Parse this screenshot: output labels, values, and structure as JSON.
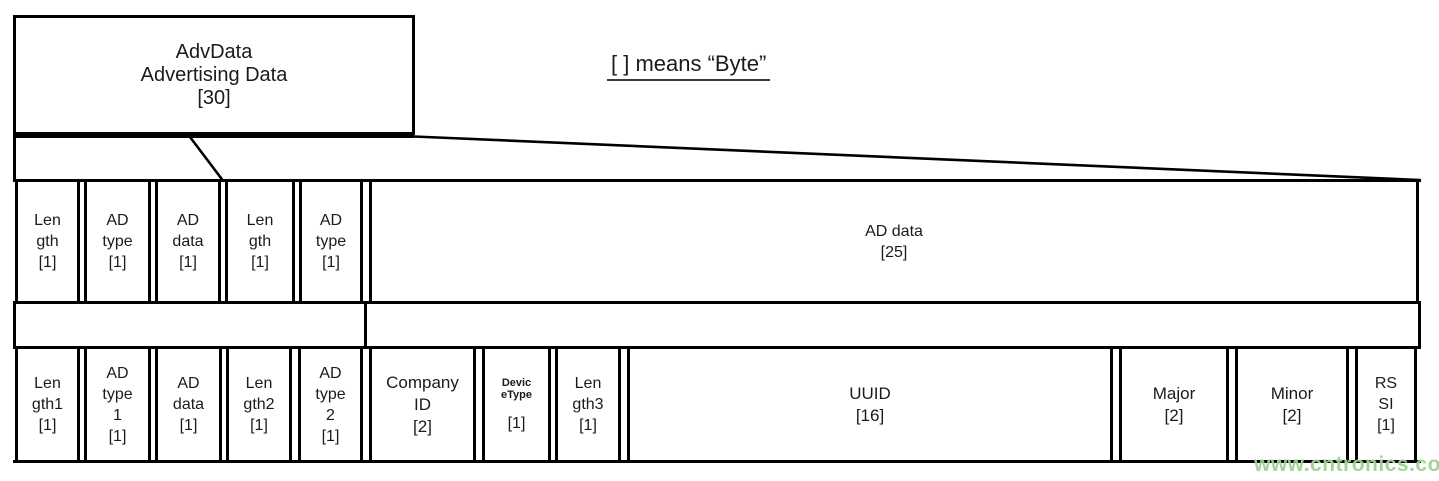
{
  "top_box": {
    "text": "AdvData\nAdvertising Data\n[30]"
  },
  "byte_note": {
    "text": "[ ] means “Byte”"
  },
  "middle_row": {
    "cells": [
      {
        "label": "Length",
        "text": "Len\ngth\n[1]"
      },
      {
        "label": "AD type",
        "text": "AD\ntype\n[1]"
      },
      {
        "label": "AD data",
        "text": "AD\ndata\n[1]"
      },
      {
        "label": "Length",
        "text": "Len\ngth\n[1]"
      },
      {
        "label": "AD type",
        "text": "AD\ntype\n[1]"
      },
      {
        "label": "AD data",
        "text": "AD data\n[25]"
      }
    ]
  },
  "bottom_row": {
    "cells": [
      {
        "label": "Length1",
        "text": "Len\ngth1\n[1]"
      },
      {
        "label": "AD type 1",
        "text": "AD\ntype\n1\n[1]"
      },
      {
        "label": "AD data",
        "text": "AD\ndata\n[1]"
      },
      {
        "label": "Length2",
        "text": "Len\ngth2\n[1]"
      },
      {
        "label": "AD type 2",
        "text": "AD\ntype\n2\n[1]"
      },
      {
        "label": "Company ID",
        "text": "Company\nID\n[2]"
      },
      {
        "label": "DeviceType",
        "small": "Devic\neType",
        "text": "[1]"
      },
      {
        "label": "Length3",
        "text": "Len\ngth3\n[1]"
      },
      {
        "label": "UUID",
        "text": "UUID\n[16]"
      },
      {
        "label": "Major",
        "text": "Major\n[2]"
      },
      {
        "label": "Minor",
        "text": "Minor\n[2]"
      },
      {
        "label": "RSSI",
        "text": "RS\nSI\n[1]"
      }
    ]
  },
  "watermark": {
    "text": "www.cntronics.com"
  },
  "colors": {
    "line": "#000000",
    "text": "#1b1b1b",
    "watermark": "#9ed193",
    "background": "#ffffff"
  }
}
